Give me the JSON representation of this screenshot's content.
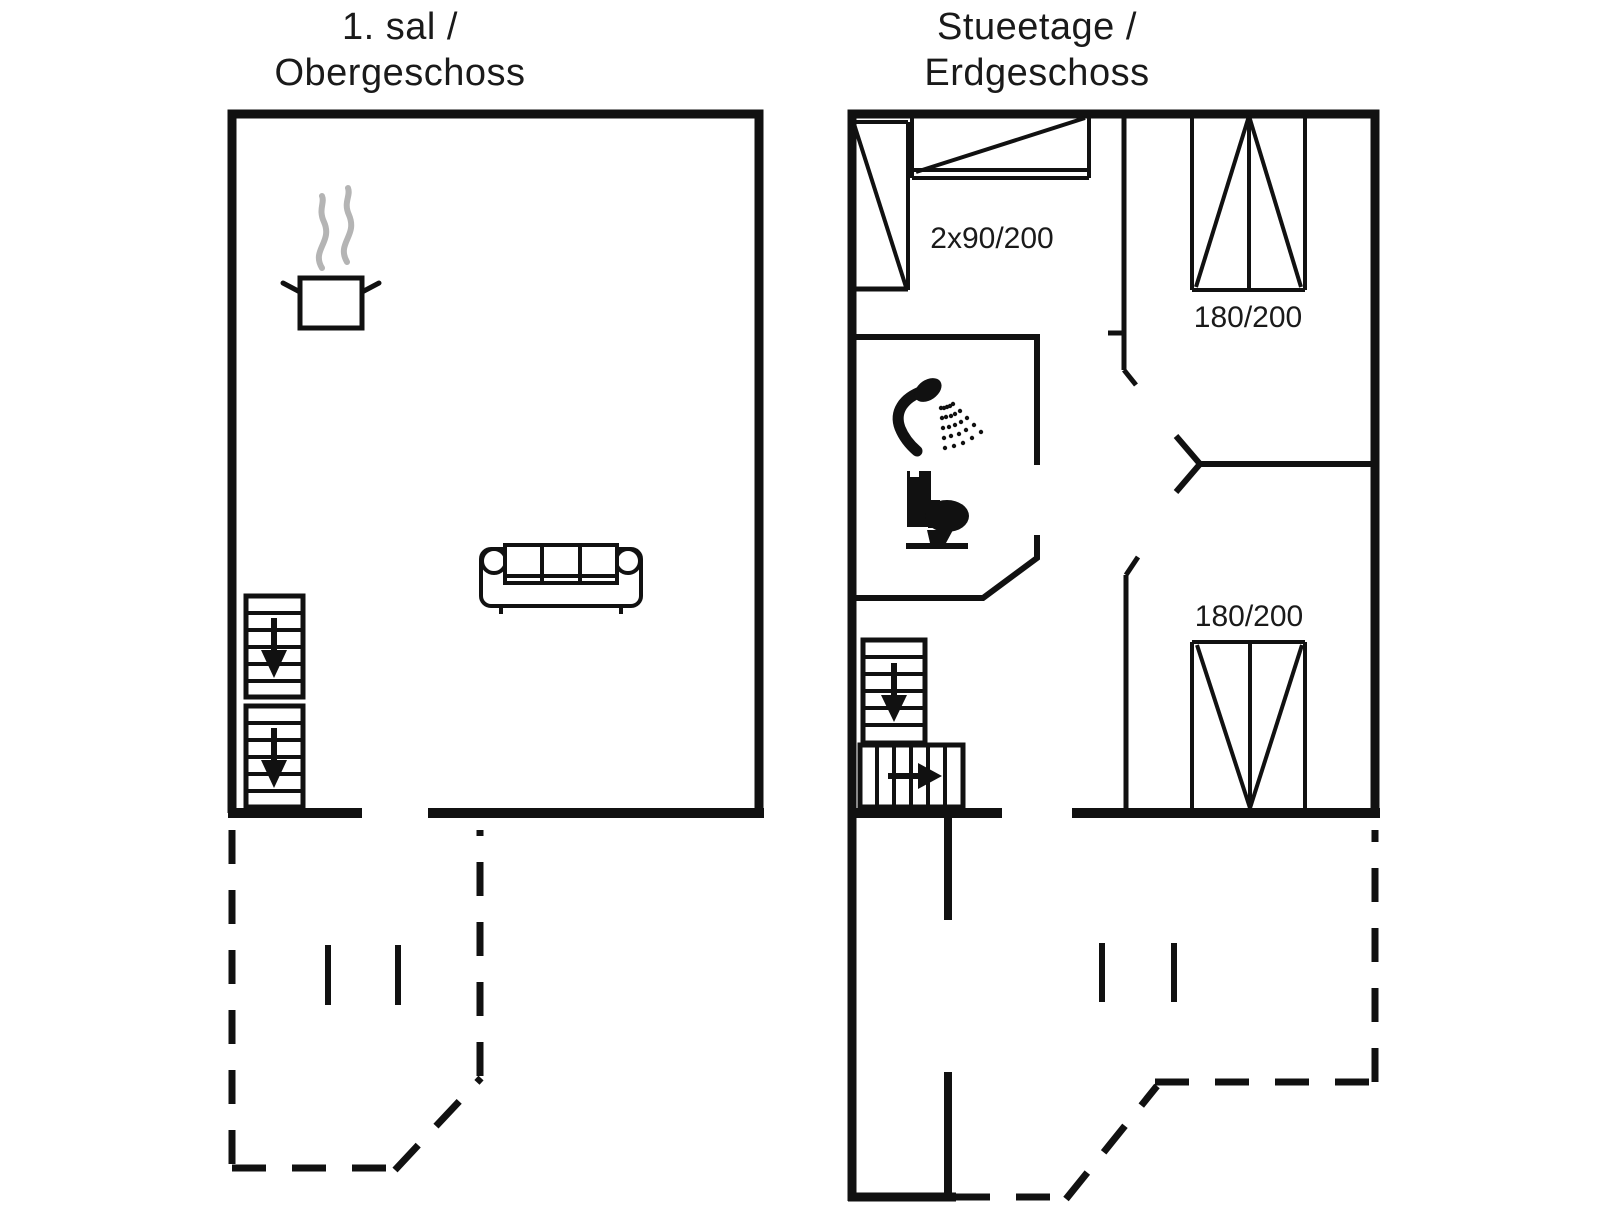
{
  "colors": {
    "background": "#ffffff",
    "line": "#111111",
    "steam": "#b4b4b4",
    "text": "#1a1a1a"
  },
  "upper_floor": {
    "title_line1": "1. sal /",
    "title_line2": "Obergeschoss"
  },
  "ground_floor": {
    "title_line1": "Stueetage /",
    "title_line2": "Erdgeschoss",
    "labels": {
      "twin_beds": "2x90/200",
      "double_bed_top": "180/200",
      "double_bed_bottom": "180/200"
    }
  },
  "icons": {
    "cooking_pot": "cooking-pot-icon",
    "steam": "steam-icon",
    "sofa": "sofa-icon",
    "stairs_down_arrow": "stairs-down-arrow-icon",
    "stairs_right_arrow": "stairs-right-arrow-icon",
    "shower": "shower-icon",
    "toilet": "toilet-icon"
  }
}
